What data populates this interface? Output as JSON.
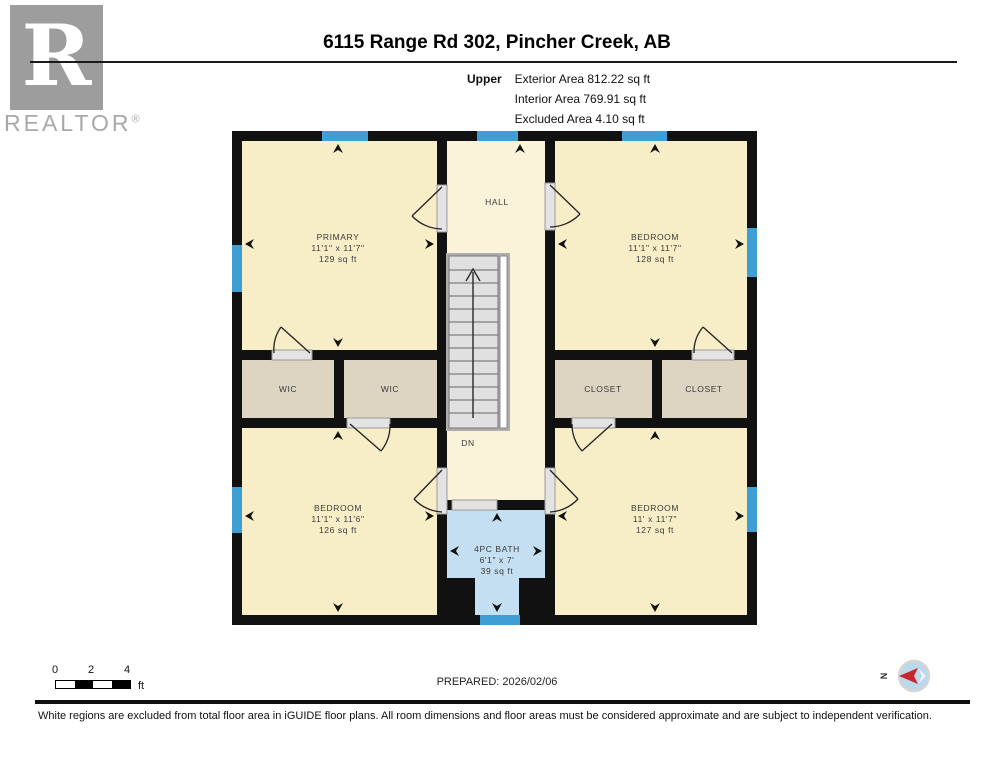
{
  "header": {
    "title": "6115 Range Rd 302, Pincher Creek, AB",
    "floor_label": "Upper",
    "area_lines": [
      "Exterior Area 812.22 sq ft",
      "Interior Area 769.91 sq ft",
      "Excluded Area 4.10 sq ft"
    ]
  },
  "logo": {
    "letter": "R",
    "wordmark": "REALTOR",
    "registered": "®"
  },
  "plan": {
    "rooms": {
      "primary": {
        "name": "PRIMARY",
        "dims": "11'1\" x 11'7\"",
        "area": "129 sq ft"
      },
      "bedroom_top_right": {
        "name": "BEDROOM",
        "dims": "11'1\" x 11'7\"",
        "area": "128 sq ft"
      },
      "bedroom_bottom_left": {
        "name": "BEDROOM",
        "dims": "11'1\" x 11'6\"",
        "area": "126 sq ft"
      },
      "bedroom_bottom_right": {
        "name": "BEDROOM",
        "dims": "11' x 11'7\"",
        "area": "127 sq ft"
      },
      "bath": {
        "name": "4PC BATH",
        "dims": "6'1\" x 7'",
        "area": "39 sq ft"
      },
      "hall": {
        "name": "HALL"
      },
      "wic_left": {
        "name": "WIC"
      },
      "wic_right": {
        "name": "WIC"
      },
      "closet_left": {
        "name": "CLOSET"
      },
      "closet_right": {
        "name": "CLOSET"
      },
      "stair_direction": "DN"
    },
    "colors": {
      "wall": "#111111",
      "room_fill": "#f7edc6",
      "hall_fill": "#faf3da",
      "closet_fill": "#ddd4c1",
      "bath_fill": "#c4dff2",
      "window_blue": "#3f9fd5",
      "stair_fill": "#e0e0e0",
      "threshold_gray": "#e3e3e3",
      "logo_gray": "#9d9d9d",
      "compass_red": "#c8252c"
    }
  },
  "footer": {
    "scale": {
      "ticks": [
        "0",
        "2",
        "4"
      ],
      "unit": "ft"
    },
    "prepared": "PREPARED: 2026/02/06",
    "compass_label": "N",
    "disclaimer": "White regions are excluded from total floor area in iGUIDE floor plans. All room dimensions and floor areas must be considered approximate and are subject to independent verification."
  }
}
